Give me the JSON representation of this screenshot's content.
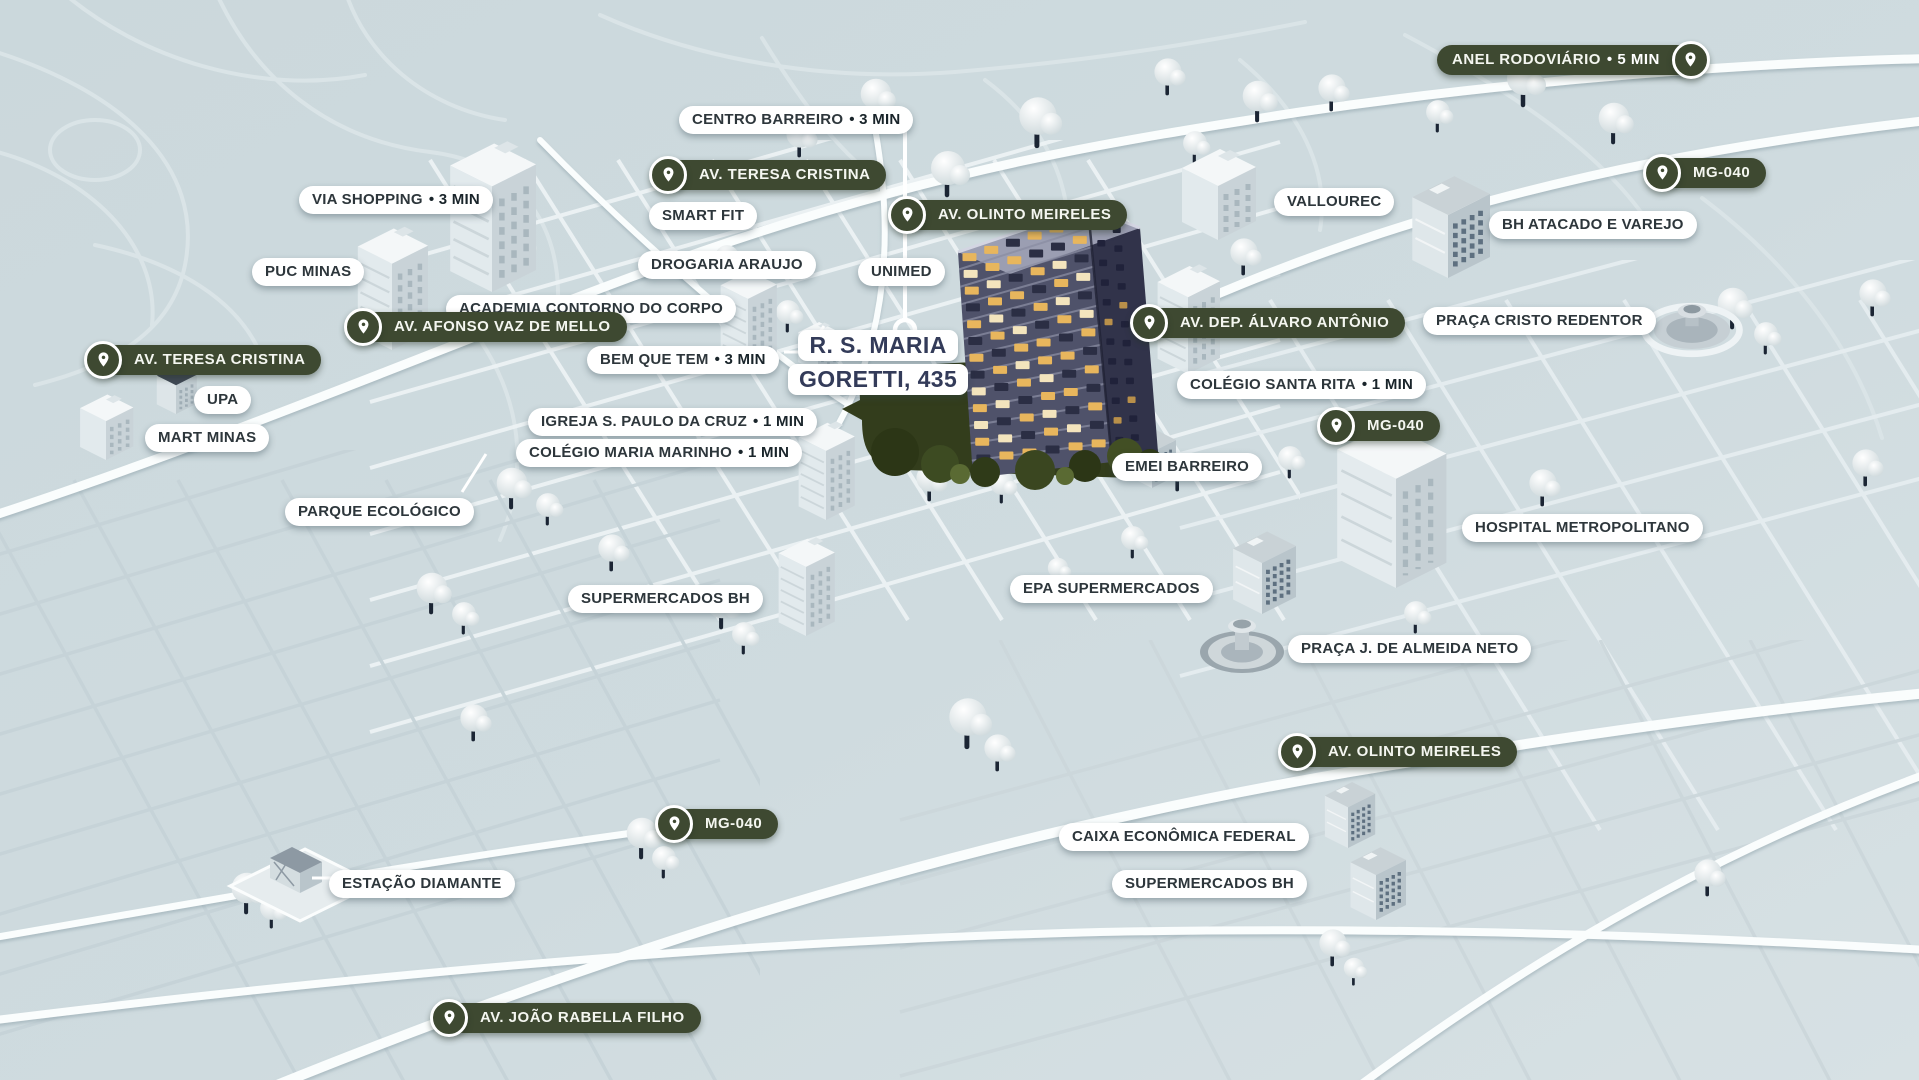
{
  "map": {
    "kind": "isometric-neighborhood-location-map",
    "address_label": {
      "line1": "R. S. MARIA",
      "line2": "GORETTI, 435"
    },
    "colors": {
      "background": "#cdd9dd",
      "road_white": "#fafdfd",
      "road_light": "#edf3f5",
      "road_dim": "#c6d3d8",
      "pill_white_bg": "#ffffff",
      "pill_white_text": "#2d363b",
      "pill_dark_bg": "#3e4931",
      "pill_dark_text": "#f4f6f0",
      "address_text": "#333b59",
      "featured_facade": "#4f526a",
      "featured_side": "#31334a",
      "window_lit": "#e8b65d",
      "foliage_dark": "#333d1c",
      "tree_trunk": "#1b2534"
    },
    "icons": {
      "pin": "location-pin-icon"
    },
    "labels": [
      {
        "id": "anel-rodoviario",
        "style": "road",
        "pin": "right",
        "text": "ANEL RODOVIÁRIO",
        "suffix": "• 5 MIN",
        "x": 1437,
        "y": 40
      },
      {
        "id": "centro-barreiro",
        "style": "callout",
        "pin": null,
        "text": "CENTRO BARREIRO",
        "suffix": "• 3 MIN",
        "x": 679,
        "y": 100
      },
      {
        "id": "av-teresa-cristina-norte",
        "style": "road",
        "pin": "left",
        "text": "AV. TERESA CRISTINA",
        "suffix": null,
        "x": 649,
        "y": 155
      },
      {
        "id": "via-shopping",
        "style": "callout",
        "pin": null,
        "text": "VIA SHOPPING",
        "suffix": "• 3 MIN",
        "x": 299,
        "y": 180
      },
      {
        "id": "smart-fit",
        "style": "callout",
        "pin": null,
        "text": "SMART FIT",
        "suffix": null,
        "x": 649,
        "y": 196
      },
      {
        "id": "av-olinto-meireles-norte",
        "style": "road",
        "pin": "left",
        "text": "AV. OLINTO MEIRELES",
        "suffix": null,
        "x": 888,
        "y": 195
      },
      {
        "id": "vallourec",
        "style": "callout",
        "pin": null,
        "text": "VALLOUREC",
        "suffix": null,
        "x": 1274,
        "y": 182
      },
      {
        "id": "mg-040-nordeste",
        "style": "road",
        "pin": "left",
        "text": "MG-040",
        "suffix": null,
        "x": 1643,
        "y": 153
      },
      {
        "id": "bh-atacado-e-varejo",
        "style": "callout",
        "pin": null,
        "text": "BH ATACADO E VAREJO",
        "suffix": null,
        "x": 1489,
        "y": 205
      },
      {
        "id": "puc-minas",
        "style": "callout",
        "pin": null,
        "text": "PUC MINAS",
        "suffix": null,
        "x": 252,
        "y": 252
      },
      {
        "id": "drogaria-araujo",
        "style": "callout",
        "pin": null,
        "text": "DROGARIA ARAUJO",
        "suffix": null,
        "x": 638,
        "y": 245
      },
      {
        "id": "unimed",
        "style": "callout",
        "pin": null,
        "text": "UNIMED",
        "suffix": null,
        "x": 858,
        "y": 252
      },
      {
        "id": "academia-contorno-do-corpo",
        "style": "callout",
        "pin": null,
        "text": "ACADEMIA CONTORNO DO CORPO",
        "suffix": null,
        "x": 446,
        "y": 289
      },
      {
        "id": "av-afonso-vaz-de-mello",
        "style": "road",
        "pin": "left",
        "text": "AV. AFONSO VAZ DE MELLO",
        "suffix": null,
        "x": 344,
        "y": 307
      },
      {
        "id": "av-dep-alvaro-antonio",
        "style": "road",
        "pin": "left",
        "text": "AV. DEP. ÁLVARO ANTÔNIO",
        "suffix": null,
        "x": 1130,
        "y": 303
      },
      {
        "id": "praca-cristo-redentor",
        "style": "callout",
        "pin": null,
        "text": "PRAÇA CRISTO REDENTOR",
        "suffix": null,
        "x": 1423,
        "y": 301
      },
      {
        "id": "bem-que-tem",
        "style": "callout",
        "pin": null,
        "text": "BEM QUE TEM",
        "suffix": "• 3 MIN",
        "x": 587,
        "y": 340
      },
      {
        "id": "av-teresa-cristina-oeste",
        "style": "road",
        "pin": "left",
        "text": "AV. TERESA CRISTINA",
        "suffix": null,
        "x": 84,
        "y": 340
      },
      {
        "id": "colegio-santa-rita",
        "style": "callout",
        "pin": null,
        "text": "COLÉGIO SANTA RITA",
        "suffix": "• 1 MIN",
        "x": 1177,
        "y": 365
      },
      {
        "id": "upa",
        "style": "callout",
        "pin": null,
        "text": "UPA",
        "suffix": null,
        "x": 194,
        "y": 380
      },
      {
        "id": "mart-minas",
        "style": "callout",
        "pin": null,
        "text": "MART MINAS",
        "suffix": null,
        "x": 145,
        "y": 418
      },
      {
        "id": "mg-040-leste",
        "style": "road",
        "pin": "left",
        "text": "MG-040",
        "suffix": null,
        "x": 1317,
        "y": 406
      },
      {
        "id": "igreja-s-paulo-da-cruz",
        "style": "callout",
        "pin": null,
        "text": "IGREJA S. PAULO DA CRUZ",
        "suffix": "• 1 MIN",
        "x": 528,
        "y": 402
      },
      {
        "id": "colegio-maria-marinho",
        "style": "callout",
        "pin": null,
        "text": "COLÉGIO MARIA MARINHO",
        "suffix": "• 1 MIN",
        "x": 516,
        "y": 433
      },
      {
        "id": "emei-barreiro",
        "style": "callout",
        "pin": null,
        "text": "EMEI BARREIRO",
        "suffix": null,
        "x": 1112,
        "y": 447
      },
      {
        "id": "parque-ecologico",
        "style": "callout",
        "pin": null,
        "text": "PARQUE ECOLÓGICO",
        "suffix": null,
        "x": 285,
        "y": 492
      },
      {
        "id": "hospital-metropolitano",
        "style": "callout",
        "pin": null,
        "text": "HOSPITAL METROPOLITANO",
        "suffix": null,
        "x": 1462,
        "y": 508
      },
      {
        "id": "supermercados-bh-centro",
        "style": "callout",
        "pin": null,
        "text": "SUPERMERCADOS BH",
        "suffix": null,
        "x": 568,
        "y": 579
      },
      {
        "id": "epa-supermercados",
        "style": "callout",
        "pin": null,
        "text": "EPA SUPERMERCADOS",
        "suffix": null,
        "x": 1010,
        "y": 569
      },
      {
        "id": "praca-j-de-almeida-neto",
        "style": "callout",
        "pin": null,
        "text": "PRAÇA J. DE ALMEIDA NETO",
        "suffix": null,
        "x": 1288,
        "y": 629
      },
      {
        "id": "av-olinto-meireles-sul",
        "style": "road",
        "pin": "left",
        "text": "AV. OLINTO MEIRELES",
        "suffix": null,
        "x": 1278,
        "y": 732
      },
      {
        "id": "mg-040-sul",
        "style": "road",
        "pin": "left",
        "text": "MG-040",
        "suffix": null,
        "x": 655,
        "y": 804
      },
      {
        "id": "caixa-economica-federal",
        "style": "callout",
        "pin": null,
        "text": "CAIXA ECONÔMICA FEDERAL",
        "suffix": null,
        "x": 1059,
        "y": 817
      },
      {
        "id": "estacao-diamante",
        "style": "callout",
        "pin": null,
        "text": "ESTAÇÃO DIAMANTE",
        "suffix": null,
        "x": 329,
        "y": 864
      },
      {
        "id": "supermercados-bh-sul",
        "style": "callout",
        "pin": null,
        "text": "SUPERMERCADOS BH",
        "suffix": null,
        "x": 1112,
        "y": 864
      },
      {
        "id": "av-joao-rabella-filho",
        "style": "road",
        "pin": "left",
        "text": "AV. JOÃO RABELLA FILHO",
        "suffix": null,
        "x": 430,
        "y": 998
      }
    ]
  }
}
